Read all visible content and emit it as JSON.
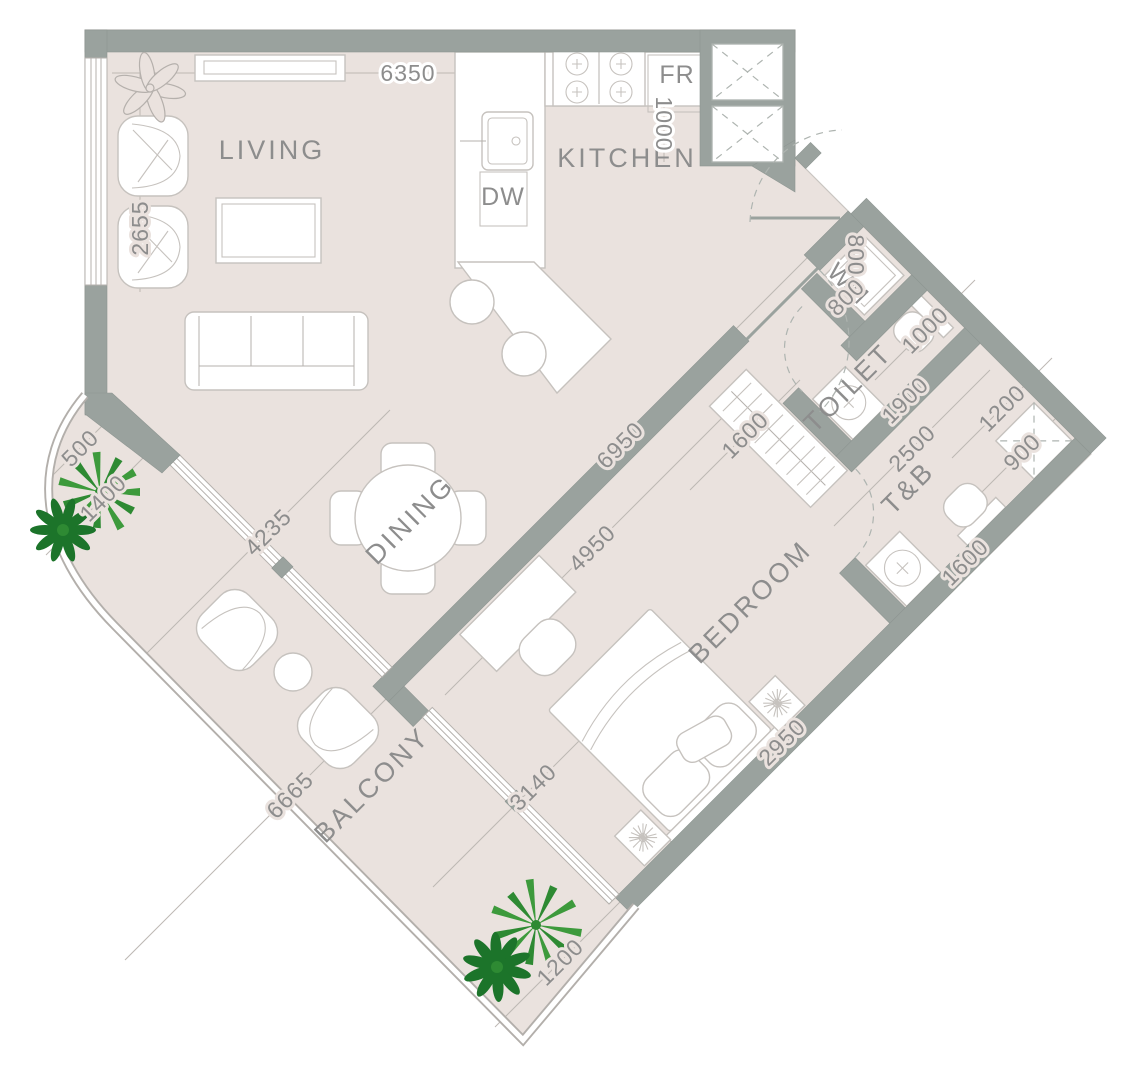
{
  "plan": {
    "title": "one-bedroom-apartment-floor-plan",
    "rooms": {
      "living": "LIVING",
      "kitchen": "KITCHEN",
      "dining": "DINING",
      "bedroom": "BEDROOM",
      "toilet": "TOILET",
      "tb": "T&B",
      "balcony": "BALCONY"
    },
    "appliances": {
      "dw": "DW",
      "fr": "FR",
      "wm": "WM"
    },
    "dimensions": {
      "top_width": "6350",
      "living_side": "2655",
      "fridge_niche": "1000",
      "wm_a": "800",
      "wm_b": "800",
      "wc_niche": "1000",
      "toilet_len": "1900",
      "tb_len": "2500",
      "shower_w": "1200",
      "shower_d": "900",
      "tb_counter": "1600",
      "wardrobe": "1600",
      "hall_len": "6950",
      "bedroom_len": "4950",
      "living_balcony_edge": "4235",
      "balcony_seg_a": "500",
      "balcony_seg_b": "1400",
      "balcony_len": "6665",
      "bedroom_balcony_edge": "3140",
      "bedroom_wall": "2950",
      "balcony_tip": "1200"
    },
    "colors": {
      "floor": "#EAE2DE",
      "wall": "#9AA29E",
      "plant_green": "#3D9A3C",
      "plant_dark": "#1C742A",
      "text": "#8D8D8D"
    }
  }
}
